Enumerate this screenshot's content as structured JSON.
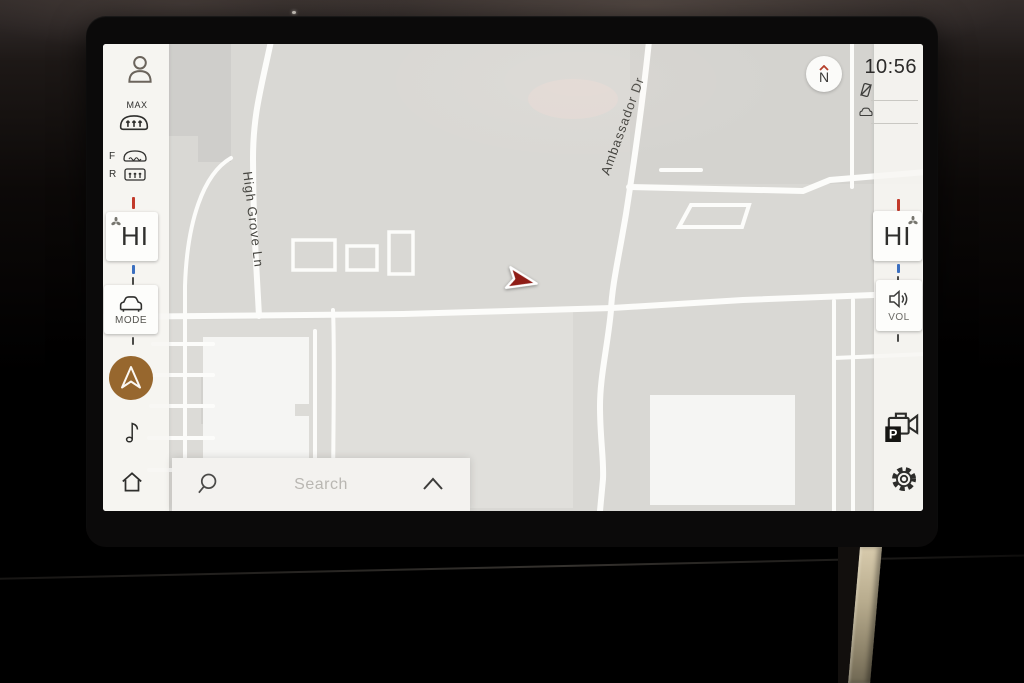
{
  "status_bar": {
    "time": "10:56"
  },
  "compass": {
    "north_label": "N"
  },
  "climate": {
    "max_defrost_label": "MAX",
    "front_defrost_label": "F",
    "rear_defrost_label": "R",
    "driver_temp": "HI",
    "passenger_temp": "HI",
    "mode_label": "MODE",
    "volume_label": "VOL"
  },
  "parking_camera": {
    "badge": "P"
  },
  "map": {
    "street_1": "High Grove Ln",
    "street_2": "Ambassador Dr"
  },
  "search": {
    "placeholder": "Search"
  },
  "colors": {
    "accent_gold": "#97672e",
    "arrow_red": "#8f1d17",
    "hot_tick": "#c23a2b",
    "cold_tick": "#3b6fc0"
  }
}
